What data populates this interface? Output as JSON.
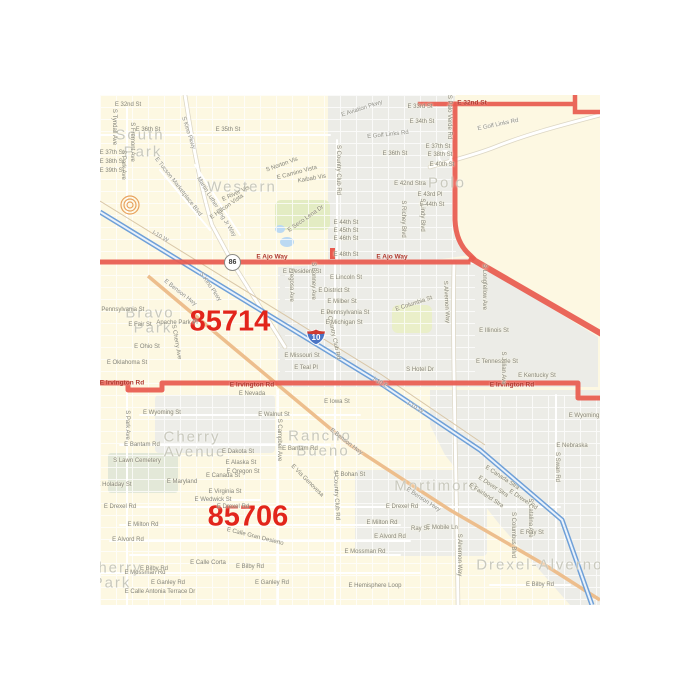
{
  "map": {
    "shields": {
      "interstate_10": "10",
      "route_86": "86"
    },
    "colors": {
      "base_yellow": "#FDF8E2",
      "built_gray": "#ECECE7",
      "boundary_red": "#E85A4E",
      "zip_text_red": "#E2251B",
      "freeway_blue": "#6FA0D8",
      "benson_orange": "#EDBE8D",
      "area_text": "#C9C9BD",
      "street_text": "#85857B"
    },
    "labels": [
      {
        "t": "85714",
        "x": 130,
        "y": 227,
        "r": 0,
        "k": "zip"
      },
      {
        "t": "85706",
        "x": 148,
        "y": 422,
        "r": 0,
        "k": "zip"
      },
      {
        "t": "South",
        "x": 40,
        "y": 40,
        "r": 0,
        "k": "area"
      },
      {
        "t": "Park",
        "x": 43,
        "y": 57,
        "r": 0,
        "k": "area"
      },
      {
        "t": "Western",
        "x": 142,
        "y": 92,
        "r": 0,
        "k": "area"
      },
      {
        "t": "Polo",
        "x": 347,
        "y": 88,
        "r": 0,
        "k": "area"
      },
      {
        "t": "Bravo",
        "x": 50,
        "y": 218,
        "r": 0,
        "k": "area"
      },
      {
        "t": "Park",
        "x": 53,
        "y": 233,
        "r": 0,
        "k": "area"
      },
      {
        "t": "Cherry",
        "x": 92,
        "y": 342,
        "r": 0,
        "k": "area"
      },
      {
        "t": "Avenue",
        "x": 95,
        "y": 357,
        "r": 0,
        "k": "area"
      },
      {
        "t": "Rancho",
        "x": 220,
        "y": 341,
        "r": 0,
        "k": "area"
      },
      {
        "t": "Bueno",
        "x": 223,
        "y": 356,
        "r": 0,
        "k": "area"
      },
      {
        "t": "Mortimore",
        "x": 337,
        "y": 391,
        "r": 0,
        "k": "area"
      },
      {
        "t": "Drexel-Alvernon",
        "x": 445,
        "y": 470,
        "r": 0,
        "k": "area"
      },
      {
        "t": "Cherry",
        "x": 14,
        "y": 473,
        "r": 0,
        "k": "area"
      },
      {
        "t": "Park",
        "x": 12,
        "y": 488,
        "r": 0,
        "k": "area"
      },
      {
        "t": "E 32nd St",
        "x": 372,
        "y": 8,
        "r": 0,
        "k": "road"
      },
      {
        "t": "E Ajo Way",
        "x": 172,
        "y": 162,
        "r": 0,
        "k": "road"
      },
      {
        "t": "E Ajo Way",
        "x": 292,
        "y": 162,
        "r": 0,
        "k": "road"
      },
      {
        "t": "E Irvington Rd",
        "x": 22,
        "y": 288,
        "r": 0,
        "k": "road"
      },
      {
        "t": "E Irvington Rd",
        "x": 152,
        "y": 290,
        "r": 0,
        "k": "road"
      },
      {
        "t": "E Irvington Rd",
        "x": 412,
        "y": 290,
        "r": 0,
        "k": "road"
      },
      {
        "t": "I-10 W",
        "x": 60,
        "y": 142,
        "r": 30,
        "k": "hwy"
      },
      {
        "t": "I-10 E",
        "x": 280,
        "y": 288,
        "r": 30,
        "k": "hwy"
      },
      {
        "t": "I-10 W",
        "x": 315,
        "y": 313,
        "r": 30,
        "k": "hwy"
      },
      {
        "t": "E Benson Hwy",
        "x": 80,
        "y": 198,
        "r": 38,
        "k": "hwy"
      },
      {
        "t": "E Benson Hwy",
        "x": 246,
        "y": 347,
        "r": 38,
        "k": "hwy"
      },
      {
        "t": "E Benson Hwy",
        "x": 323,
        "y": 405,
        "r": 33,
        "k": "hwy"
      },
      {
        "t": "S Kino Pkwy",
        "x": 88,
        "y": 38,
        "r": 72,
        "k": "hwy"
      },
      {
        "t": "S Kino Pkwy",
        "x": 110,
        "y": 192,
        "r": 55,
        "k": "hwy"
      },
      {
        "t": "Martin Luther King Jr Way",
        "x": 116,
        "y": 112,
        "r": 58,
        "k": "hwy"
      },
      {
        "t": "E Tucson Marketplace Blvd",
        "x": 78,
        "y": 92,
        "r": 52,
        "k": "hwy"
      },
      {
        "t": "E Golf Links Rd",
        "x": 398,
        "y": 30,
        "r": -12,
        "k": "hwy"
      },
      {
        "t": "E Golf Links Rd",
        "x": 288,
        "y": 40,
        "r": -6,
        "k": "hwy"
      },
      {
        "t": "E Aviation Pkwy",
        "x": 262,
        "y": 14,
        "r": -18,
        "k": "hwy"
      },
      {
        "t": "E 32nd St",
        "x": 28,
        "y": 10,
        "r": 0,
        "k": "street"
      },
      {
        "t": "E 33rd St",
        "x": 320,
        "y": 12,
        "r": 0,
        "k": "street"
      },
      {
        "t": "E 34th St",
        "x": 322,
        "y": 27,
        "r": 0,
        "k": "street"
      },
      {
        "t": "E 35th St",
        "x": 128,
        "y": 35,
        "r": 0,
        "k": "street"
      },
      {
        "t": "E 36th St",
        "x": 48,
        "y": 35,
        "r": 0,
        "k": "street"
      },
      {
        "t": "E 36th St",
        "x": 295,
        "y": 59,
        "r": 0,
        "k": "street"
      },
      {
        "t": "E 37th St",
        "x": 12,
        "y": 58,
        "r": 0,
        "k": "street"
      },
      {
        "t": "E 38th St",
        "x": 12,
        "y": 67,
        "r": 0,
        "k": "street"
      },
      {
        "t": "E 39th St",
        "x": 12,
        "y": 76,
        "r": 0,
        "k": "street"
      },
      {
        "t": "E 37th St",
        "x": 338,
        "y": 52,
        "r": 0,
        "k": "street"
      },
      {
        "t": "E 38th St",
        "x": 340,
        "y": 60,
        "r": 0,
        "k": "street"
      },
      {
        "t": "E 40th St",
        "x": 342,
        "y": 70,
        "r": 0,
        "k": "street"
      },
      {
        "t": "E 42nd Stra",
        "x": 310,
        "y": 89,
        "r": 0,
        "k": "street"
      },
      {
        "t": "E 43rd Pl",
        "x": 330,
        "y": 100,
        "r": 0,
        "k": "street"
      },
      {
        "t": "E 44th St",
        "x": 332,
        "y": 110,
        "r": 0,
        "k": "street"
      },
      {
        "t": "E 44th St",
        "x": 246,
        "y": 128,
        "r": 0,
        "k": "street"
      },
      {
        "t": "E 45th St",
        "x": 246,
        "y": 136,
        "r": 0,
        "k": "street"
      },
      {
        "t": "E 46th St",
        "x": 246,
        "y": 144,
        "r": 0,
        "k": "street"
      },
      {
        "t": "E 48th St",
        "x": 246,
        "y": 160,
        "r": 0,
        "k": "street"
      },
      {
        "t": "S Tyndall Ave",
        "x": 14,
        "y": 32,
        "r": 90,
        "k": "street"
      },
      {
        "t": "S Fremont Ave",
        "x": 32,
        "y": 47,
        "r": 90,
        "k": "street"
      },
      {
        "t": "S Park Ave",
        "x": 23,
        "y": 70,
        "r": 90,
        "k": "street"
      },
      {
        "t": "S Park Ave",
        "x": 27,
        "y": 330,
        "r": 90,
        "k": "street"
      },
      {
        "t": "S Country Club Rd",
        "x": 238,
        "y": 75,
        "r": 90,
        "k": "street"
      },
      {
        "t": "S Country Club Rd",
        "x": 233,
        "y": 240,
        "r": 78,
        "k": "street"
      },
      {
        "t": "S Country Club Rd",
        "x": 236,
        "y": 400,
        "r": 87,
        "k": "street"
      },
      {
        "t": "S Norton Vis",
        "x": 182,
        "y": 70,
        "r": -20,
        "k": "street"
      },
      {
        "t": "E Camino Vista",
        "x": 197,
        "y": 78,
        "r": -15,
        "k": "street"
      },
      {
        "t": "Kaibab Vis",
        "x": 212,
        "y": 84,
        "r": -10,
        "k": "street"
      },
      {
        "t": "E River Vis",
        "x": 136,
        "y": 99,
        "r": -25,
        "k": "street"
      },
      {
        "t": "E Halcon Vista",
        "x": 127,
        "y": 112,
        "r": -35,
        "k": "street"
      },
      {
        "t": "E Seco Lena Dr",
        "x": 206,
        "y": 124,
        "r": -35,
        "k": "street"
      },
      {
        "t": "S Palo Verde Rd",
        "x": 349,
        "y": 22,
        "r": 90,
        "k": "street"
      },
      {
        "t": "S Richey Blvd",
        "x": 303,
        "y": 124,
        "r": 90,
        "k": "street"
      },
      {
        "t": "S Lindy Blvd",
        "x": 322,
        "y": 120,
        "r": 90,
        "k": "street"
      },
      {
        "t": "E President St",
        "x": 202,
        "y": 177,
        "r": 0,
        "k": "street"
      },
      {
        "t": "E Lincoln St",
        "x": 246,
        "y": 183,
        "r": 0,
        "k": "street"
      },
      {
        "t": "E District St",
        "x": 234,
        "y": 196,
        "r": 0,
        "k": "street"
      },
      {
        "t": "E Milber St",
        "x": 242,
        "y": 207,
        "r": 0,
        "k": "street"
      },
      {
        "t": "E Pennsylvania St",
        "x": 245,
        "y": 218,
        "r": 0,
        "k": "street"
      },
      {
        "t": "E Michigan St",
        "x": 244,
        "y": 228,
        "r": 0,
        "k": "street"
      },
      {
        "t": "E Columbia St",
        "x": 314,
        "y": 209,
        "r": -18,
        "k": "street"
      },
      {
        "t": "S Bonney Ave",
        "x": 213,
        "y": 186,
        "r": 90,
        "k": "street"
      },
      {
        "t": "Fregosa Ave",
        "x": 191,
        "y": 190,
        "r": 90,
        "k": "street"
      },
      {
        "t": "E Missouri St",
        "x": 202,
        "y": 261,
        "r": 0,
        "k": "street"
      },
      {
        "t": "E Teal Pl",
        "x": 206,
        "y": 273,
        "r": 0,
        "k": "street"
      },
      {
        "t": "S Alvernon Way",
        "x": 346,
        "y": 207,
        "r": 87,
        "k": "street"
      },
      {
        "t": "S Alvernon Way",
        "x": 359,
        "y": 460,
        "r": 90,
        "k": "street"
      },
      {
        "t": "S Longfellow Ave",
        "x": 384,
        "y": 192,
        "r": 90,
        "k": "street"
      },
      {
        "t": "E Illinois St",
        "x": 394,
        "y": 236,
        "r": 0,
        "k": "street"
      },
      {
        "t": "E Tennessee St",
        "x": 397,
        "y": 267,
        "r": 0,
        "k": "street"
      },
      {
        "t": "E Kentucky St",
        "x": 437,
        "y": 281,
        "r": 0,
        "k": "street"
      },
      {
        "t": "S Julian Ave",
        "x": 403,
        "y": 273,
        "r": 90,
        "k": "street"
      },
      {
        "t": "S Hotel Dr",
        "x": 320,
        "y": 275,
        "r": 0,
        "k": "street"
      },
      {
        "t": "E Wyoming",
        "x": 484,
        "y": 321,
        "r": 0,
        "k": "street"
      },
      {
        "t": "E Nebraska",
        "x": 472,
        "y": 351,
        "r": 0,
        "k": "street"
      },
      {
        "t": "S Swan Rd",
        "x": 457,
        "y": 372,
        "r": 90,
        "k": "street"
      },
      {
        "t": "E Nevada",
        "x": 152,
        "y": 299,
        "r": 0,
        "k": "street"
      },
      {
        "t": "E Iowa St",
        "x": 237,
        "y": 307,
        "r": 0,
        "k": "street"
      },
      {
        "t": "E Wyoming St",
        "x": 62,
        "y": 318,
        "r": 0,
        "k": "street"
      },
      {
        "t": "E Walnut St",
        "x": 174,
        "y": 320,
        "r": 0,
        "k": "street"
      },
      {
        "t": "E Oklahoma St",
        "x": 27,
        "y": 268,
        "r": 0,
        "k": "street"
      },
      {
        "t": "E Ohio St",
        "x": 47,
        "y": 252,
        "r": 0,
        "k": "street"
      },
      {
        "t": "E Fair St",
        "x": 40,
        "y": 230,
        "r": 0,
        "k": "street"
      },
      {
        "t": "E Pennsylvania St",
        "x": 20,
        "y": 215,
        "r": 0,
        "k": "street"
      },
      {
        "t": "Apache Park Pl",
        "x": 77,
        "y": 228,
        "r": 0,
        "k": "street"
      },
      {
        "t": "S Cherry Ave",
        "x": 76,
        "y": 247,
        "r": 80,
        "k": "street"
      },
      {
        "t": "S Campbell Ave",
        "x": 179,
        "y": 345,
        "r": 90,
        "k": "street"
      },
      {
        "t": "E Bantam Rd",
        "x": 42,
        "y": 350,
        "r": 0,
        "k": "street"
      },
      {
        "t": "E Bantam Rd",
        "x": 200,
        "y": 354,
        "r": 0,
        "k": "street"
      },
      {
        "t": "S Lawn Cemetery",
        "x": 37,
        "y": 366,
        "r": 0,
        "k": "street"
      },
      {
        "t": "E Dakota St",
        "x": 138,
        "y": 357,
        "r": 0,
        "k": "street"
      },
      {
        "t": "E Alaska St",
        "x": 141,
        "y": 368,
        "r": 0,
        "k": "street"
      },
      {
        "t": "E Oregon St",
        "x": 143,
        "y": 377,
        "r": 0,
        "k": "street"
      },
      {
        "t": "E Canada St",
        "x": 123,
        "y": 381,
        "r": 0,
        "k": "street"
      },
      {
        "t": "E Virginia St",
        "x": 125,
        "y": 397,
        "r": 0,
        "k": "street"
      },
      {
        "t": "E Wedwick St",
        "x": 113,
        "y": 405,
        "r": 0,
        "k": "street"
      },
      {
        "t": "E Via Genovesa",
        "x": 207,
        "y": 386,
        "r": 45,
        "k": "street"
      },
      {
        "t": "E Holaday St",
        "x": 14,
        "y": 390,
        "r": 0,
        "k": "street"
      },
      {
        "t": "E Maryland",
        "x": 82,
        "y": 387,
        "r": 0,
        "k": "street"
      },
      {
        "t": "E Drexel Rd",
        "x": 20,
        "y": 412,
        "r": 0,
        "k": "street"
      },
      {
        "t": "E Drexel Rd",
        "x": 133,
        "y": 412,
        "r": 0,
        "k": "street"
      },
      {
        "t": "E Drexel Rd",
        "x": 302,
        "y": 412,
        "r": 0,
        "k": "street"
      },
      {
        "t": "E Milton Rd",
        "x": 43,
        "y": 430,
        "r": 0,
        "k": "street"
      },
      {
        "t": "E Milton Rd",
        "x": 282,
        "y": 428,
        "r": 0,
        "k": "street"
      },
      {
        "t": "E Alvord Rd",
        "x": 28,
        "y": 445,
        "r": 0,
        "k": "street"
      },
      {
        "t": "E Alvord Rd",
        "x": 290,
        "y": 442,
        "r": 0,
        "k": "street"
      },
      {
        "t": "E Mossman Rd",
        "x": 45,
        "y": 478,
        "r": 0,
        "k": "street"
      },
      {
        "t": "E Mossman Rd",
        "x": 265,
        "y": 457,
        "r": 0,
        "k": "street"
      },
      {
        "t": "E Bilby Rd",
        "x": 54,
        "y": 474,
        "r": 0,
        "k": "street"
      },
      {
        "t": "E Bilby Rd",
        "x": 150,
        "y": 472,
        "r": 0,
        "k": "street"
      },
      {
        "t": "E Bilby Rd",
        "x": 440,
        "y": 490,
        "r": 0,
        "k": "street"
      },
      {
        "t": "E Calle Corta",
        "x": 108,
        "y": 468,
        "r": 0,
        "k": "street"
      },
      {
        "t": "E Calle Gran Desierto",
        "x": 155,
        "y": 442,
        "r": 14,
        "k": "street"
      },
      {
        "t": "E Ganley Rd",
        "x": 68,
        "y": 488,
        "r": 0,
        "k": "street"
      },
      {
        "t": "E Ganley Rd",
        "x": 172,
        "y": 488,
        "r": 0,
        "k": "street"
      },
      {
        "t": "E Calle Antonia Terrace Dr",
        "x": 60,
        "y": 497,
        "r": 0,
        "k": "street"
      },
      {
        "t": "E Hemisphere Loop",
        "x": 275,
        "y": 491,
        "r": 0,
        "k": "street"
      },
      {
        "t": "E Bohan St",
        "x": 250,
        "y": 380,
        "r": 0,
        "k": "street"
      },
      {
        "t": "E Canada Stra",
        "x": 402,
        "y": 383,
        "r": 33,
        "k": "street"
      },
      {
        "t": "E Dover Stra",
        "x": 393,
        "y": 392,
        "r": 33,
        "k": "street"
      },
      {
        "t": "E Fairland Stra",
        "x": 386,
        "y": 401,
        "r": 33,
        "k": "street"
      },
      {
        "t": "E Drexel Rd",
        "x": 423,
        "y": 405,
        "r": 33,
        "k": "street"
      },
      {
        "t": "S Catalina Ave",
        "x": 430,
        "y": 423,
        "r": 90,
        "k": "street"
      },
      {
        "t": "E Ray St",
        "x": 432,
        "y": 438,
        "r": 0,
        "k": "street"
      },
      {
        "t": "Ray St",
        "x": 320,
        "y": 434,
        "r": 0,
        "k": "street"
      },
      {
        "t": "E Mobile Ln",
        "x": 342,
        "y": 433,
        "r": 0,
        "k": "street"
      },
      {
        "t": "S Columbus Blvd",
        "x": 413,
        "y": 440,
        "r": 90,
        "k": "street"
      }
    ]
  }
}
